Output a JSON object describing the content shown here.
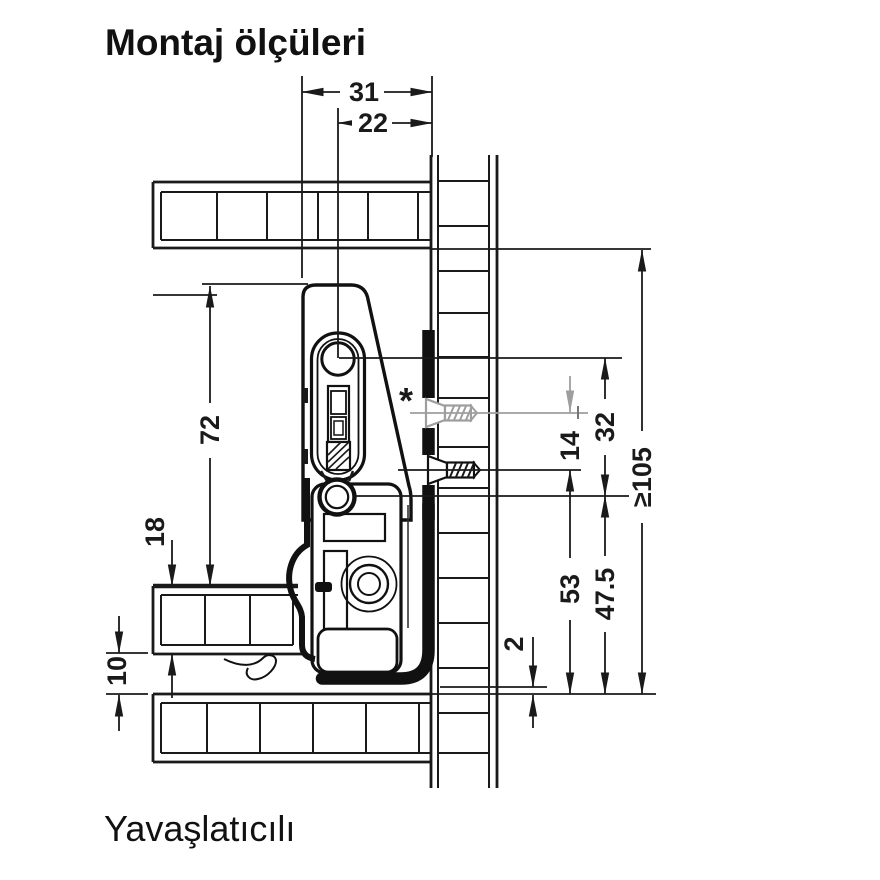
{
  "page": {
    "title": "Montaj ölçüleri",
    "caption": "Yavaşlatıcılı"
  },
  "drawing": {
    "dims": {
      "d31": "31",
      "d22": "22",
      "d72": "72",
      "d18": "18",
      "d10": "10",
      "d32": "32",
      "d14": "14",
      "d105": "≥105",
      "d53": "53",
      "d47_5": "47.5",
      "d2": "2"
    },
    "asterisk": "*",
    "colors": {
      "line": "#1a1a1a",
      "optional_gray": "#9e9e9e"
    }
  }
}
